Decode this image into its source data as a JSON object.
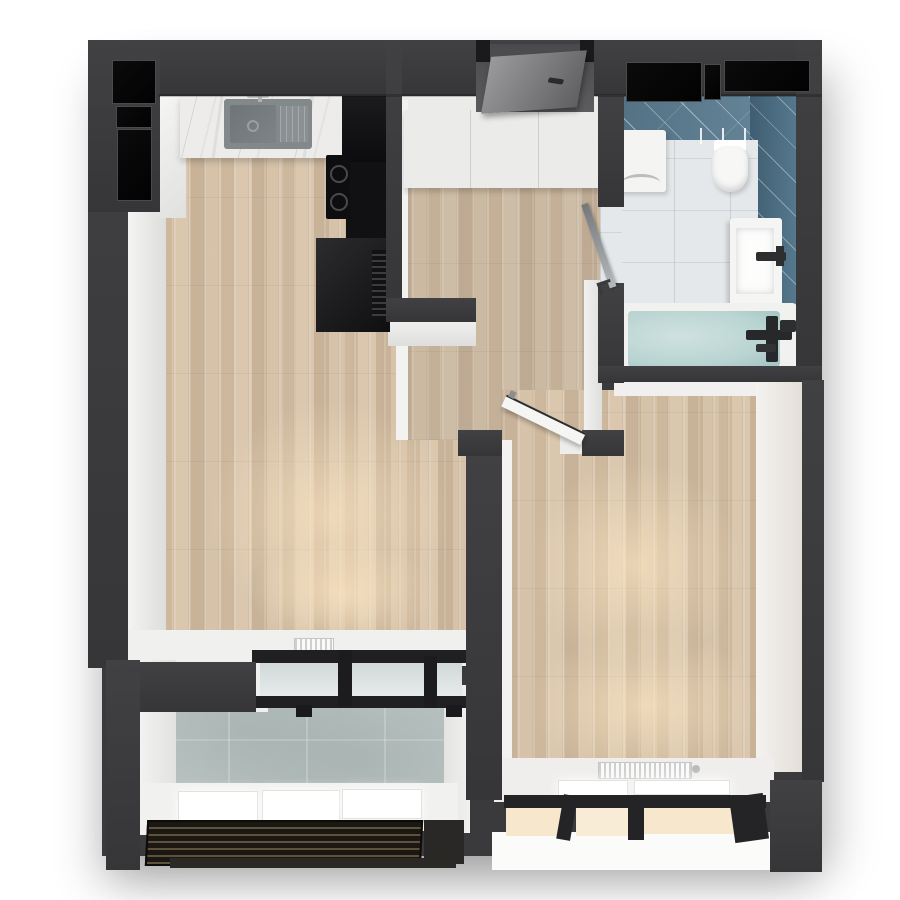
{
  "scene": {
    "kind": "apartment-floor-plan-3d-render-top-view",
    "background": "#ffffff",
    "has_text": false
  },
  "palette": {
    "wall": "#3b3b3d",
    "wall_panel_black": "#060607",
    "interior_white": "#f1f1ef",
    "wood_floor": "#d3c0a8",
    "marble_counter": "#edecea",
    "kitchen_cabinet_dark": "#121214",
    "bath_wall_tile": "#5f8196",
    "bath_wall_tile_dark": "#4d7289",
    "bath_floor_tile": "#e4e8ea",
    "bath_water": "#b9d4d2",
    "balcony_concrete": "#b9c3c2",
    "window_frame": "#202022",
    "warm_glow": "#f6e7cd",
    "fixture_white": "#f5f5f4"
  },
  "rooms": [
    {
      "name": "kitchen-living-room",
      "floor": "wood-planks",
      "fixtures": [
        "marble-counter",
        "kitchen-sink",
        "kitchen-faucet",
        "induction-cooktop",
        "tall-dark-cabinets",
        "ventilation-grille",
        "radiator",
        "balcony-sliding-door"
      ]
    },
    {
      "name": "hallway",
      "floor": "wood-planks",
      "fixtures": [
        "entry-door",
        "wardrobe",
        "bathroom-glass-door"
      ]
    },
    {
      "name": "bathroom",
      "floor": "white-tile",
      "fixtures": [
        "washing-machine",
        "toilet",
        "vanity-sink",
        "bathtub",
        "shower-mixer"
      ]
    },
    {
      "name": "bedroom",
      "floor": "wood-planks",
      "fixtures": [
        "bedroom-door",
        "radiator",
        "bay-window"
      ]
    },
    {
      "name": "balcony",
      "floor": "concrete-tile",
      "fixtures": [
        "glass-railing",
        "drainage-grate"
      ]
    }
  ]
}
